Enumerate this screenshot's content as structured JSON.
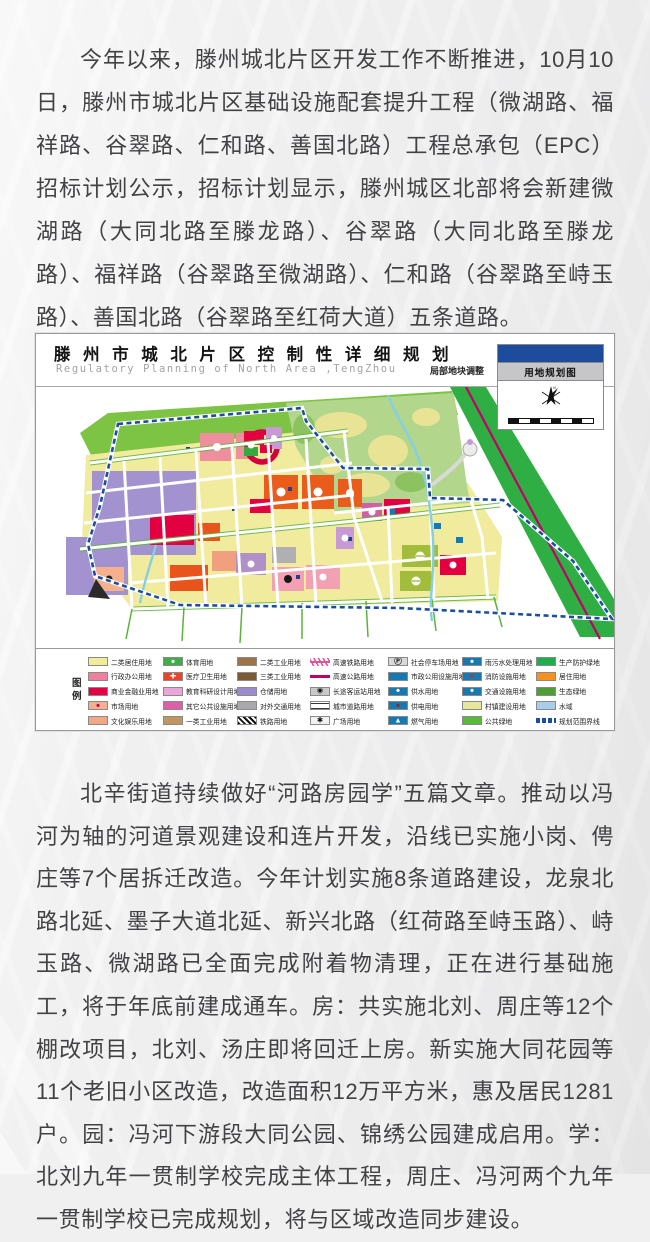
{
  "article": {
    "paragraph_1": "今年以来，滕州城北片区开发工作不断推进，10月10日，滕州市城北片区基础设施配套提升工程（微湖路、福祥路、谷翠路、仁和路、善国北路）工程总承包（EPC）招标计划公示，招标计划显示，滕州城区北部将会新建微湖路（大同北路至滕龙路）、谷翠路（大同北路至滕龙路）、福祥路（谷翠路至微湖路）、仁和路（谷翠路至峙玉路）、善国北路（谷翠路至红荷大道）五条道路。",
    "paragraph_2": "北辛街道持续做好“河路房园学”五篇文章。推动以冯河为轴的河道景观建设和连片开发，沿线已实施小岗、俜庄等7个居拆迁改造。今年计划实施8条道路建设，龙泉北路北延、墨子大道北延、新兴北路（红荷路至峙玉路）、峙玉路、微湖路已全面完成附着物清理，正在进行基础施工，将于年底前建成通车。房：共实施北刘、周庄等12个棚改项目，北刘、汤庄即将回迁上房。新实施大同花园等11个老旧小区改造，改造面积12万平方米，惠及居民1281户。园：冯河下游段大同公园、锦绣公园建成启用。学：北刘九年一贯制学校完成主体工程，周庄、冯河两个九年一贯制学校已完成规划，将与区域改造同步建设。"
  },
  "map_figure": {
    "title": "滕 州 市 城 北 片 区 控 制 性 详 细 规 划",
    "subtitle": "Regulatory Planning of North Area ,TengZhou",
    "adjustment_note": "局部地块调整",
    "panel": {
      "title": "用地规划图",
      "compass_label": "N"
    },
    "colors": {
      "boundary_blue": "#1c4ea0",
      "highway_magenta": "#c2006a",
      "panel_blue": "#1e4c9c",
      "parcel_yellow": "#f0eb9d",
      "park_green": "#b2d78c",
      "corridor_green": "#2fae44"
    },
    "legend": {
      "title_chars": [
        "图",
        "例"
      ],
      "columns": [
        [
          {
            "label": "二类居住用地",
            "swatch": "fill",
            "color": "#f0ec9a"
          },
          {
            "label": "行政办公用地",
            "swatch": "fill",
            "color": "#ef7f9e"
          },
          {
            "label": "商业金融业用地",
            "swatch": "fill",
            "color": "#e50045"
          },
          {
            "label": "市场用地",
            "swatch": "glyph",
            "color": "#f4b090",
            "glyph": "●",
            "glyph_color": "#d2003c"
          },
          {
            "label": "文化娱乐用地",
            "swatch": "fill",
            "color": "#f2a884"
          }
        ],
        [
          {
            "label": "体育用地",
            "swatch": "glyph",
            "color": "#3fae49",
            "glyph": "●",
            "glyph_color": "#ffffff"
          },
          {
            "label": "医疗卫生用地",
            "swatch": "glyph",
            "color": "#e8442c",
            "glyph": "✚",
            "glyph_color": "#ffffff"
          },
          {
            "label": "教育科研设计用地",
            "swatch": "fill",
            "color": "#eaa6d8"
          },
          {
            "label": "其它公共设施用地",
            "swatch": "fill",
            "color": "#dd5fa8"
          },
          {
            "label": "一类工业用地",
            "swatch": "fill",
            "color": "#bf9560"
          }
        ],
        [
          {
            "label": "二类工业用地",
            "swatch": "fill",
            "color": "#9d7347"
          },
          {
            "label": "三类工业用地",
            "swatch": "fill",
            "color": "#7c5a33"
          },
          {
            "label": "仓储用地",
            "swatch": "fill",
            "color": "#9c8ccf"
          },
          {
            "label": "对外交通用地",
            "swatch": "fill",
            "color": "#a9a9ab"
          },
          {
            "label": "铁路用地",
            "swatch": "hatch",
            "color": "#111111"
          }
        ],
        [
          {
            "label": "高速铁路用地",
            "swatch": "railline",
            "color": "#e0559a"
          },
          {
            "label": "高速公路用地",
            "swatch": "line",
            "color": "#c0006a"
          },
          {
            "label": "长途客运站用地",
            "swatch": "glyph",
            "color": "#c9c9c9",
            "glyph": "◉",
            "glyph_color": "#111111"
          },
          {
            "label": "城市道路用地",
            "swatch": "road",
            "color": "#3a3a3a"
          },
          {
            "label": "广场用地",
            "swatch": "glyph",
            "color": "#f2f2f2",
            "glyph": "✱",
            "glyph_color": "#111111"
          }
        ],
        [
          {
            "label": "社会停车场用地",
            "swatch": "glyph",
            "color": "#d8d8d8",
            "glyph": "Ⓟ",
            "glyph_color": "#111111"
          },
          {
            "label": "市政公用设施用地",
            "swatch": "fill",
            "color": "#1878b0"
          },
          {
            "label": "供水用地",
            "swatch": "glyph",
            "color": "#1878b0",
            "glyph": "●",
            "glyph_color": "#ffffff"
          },
          {
            "label": "供电用地",
            "swatch": "glyph",
            "color": "#1878b0",
            "glyph": "●",
            "glyph_color": "#a02020"
          },
          {
            "label": "燃气用地",
            "swatch": "glyph",
            "color": "#1878b0",
            "glyph": "▲",
            "glyph_color": "#ffffff"
          }
        ],
        [
          {
            "label": "雨污水处理用地",
            "swatch": "glyph",
            "color": "#1878b0",
            "glyph": "●",
            "glyph_color": "#ffffff"
          },
          {
            "label": "消防设施用地",
            "swatch": "glyph",
            "color": "#1878b0",
            "glyph": "●",
            "glyph_color": "#c03030"
          },
          {
            "label": "交通设施用地",
            "swatch": "glyph",
            "color": "#1878b0",
            "glyph": "●",
            "glyph_color": "#ffffff"
          },
          {
            "label": "村镇建设用地",
            "swatch": "fill",
            "color": "#e8e79c"
          },
          {
            "label": "公共绿地",
            "swatch": "fill",
            "color": "#5bb83a"
          }
        ],
        [
          {
            "label": "生产防护绿地",
            "swatch": "fill",
            "color": "#1fae4e"
          },
          {
            "label": "居住用地",
            "swatch": "fill",
            "color": "#f6911e"
          },
          {
            "label": "生态绿地",
            "swatch": "fill",
            "color": "#4c9e35"
          },
          {
            "label": "水域",
            "swatch": "fill",
            "color": "#a9cce8"
          },
          {
            "label": "规划范围界线",
            "swatch": "dash",
            "color": "#1c4ea0"
          }
        ]
      ]
    }
  }
}
